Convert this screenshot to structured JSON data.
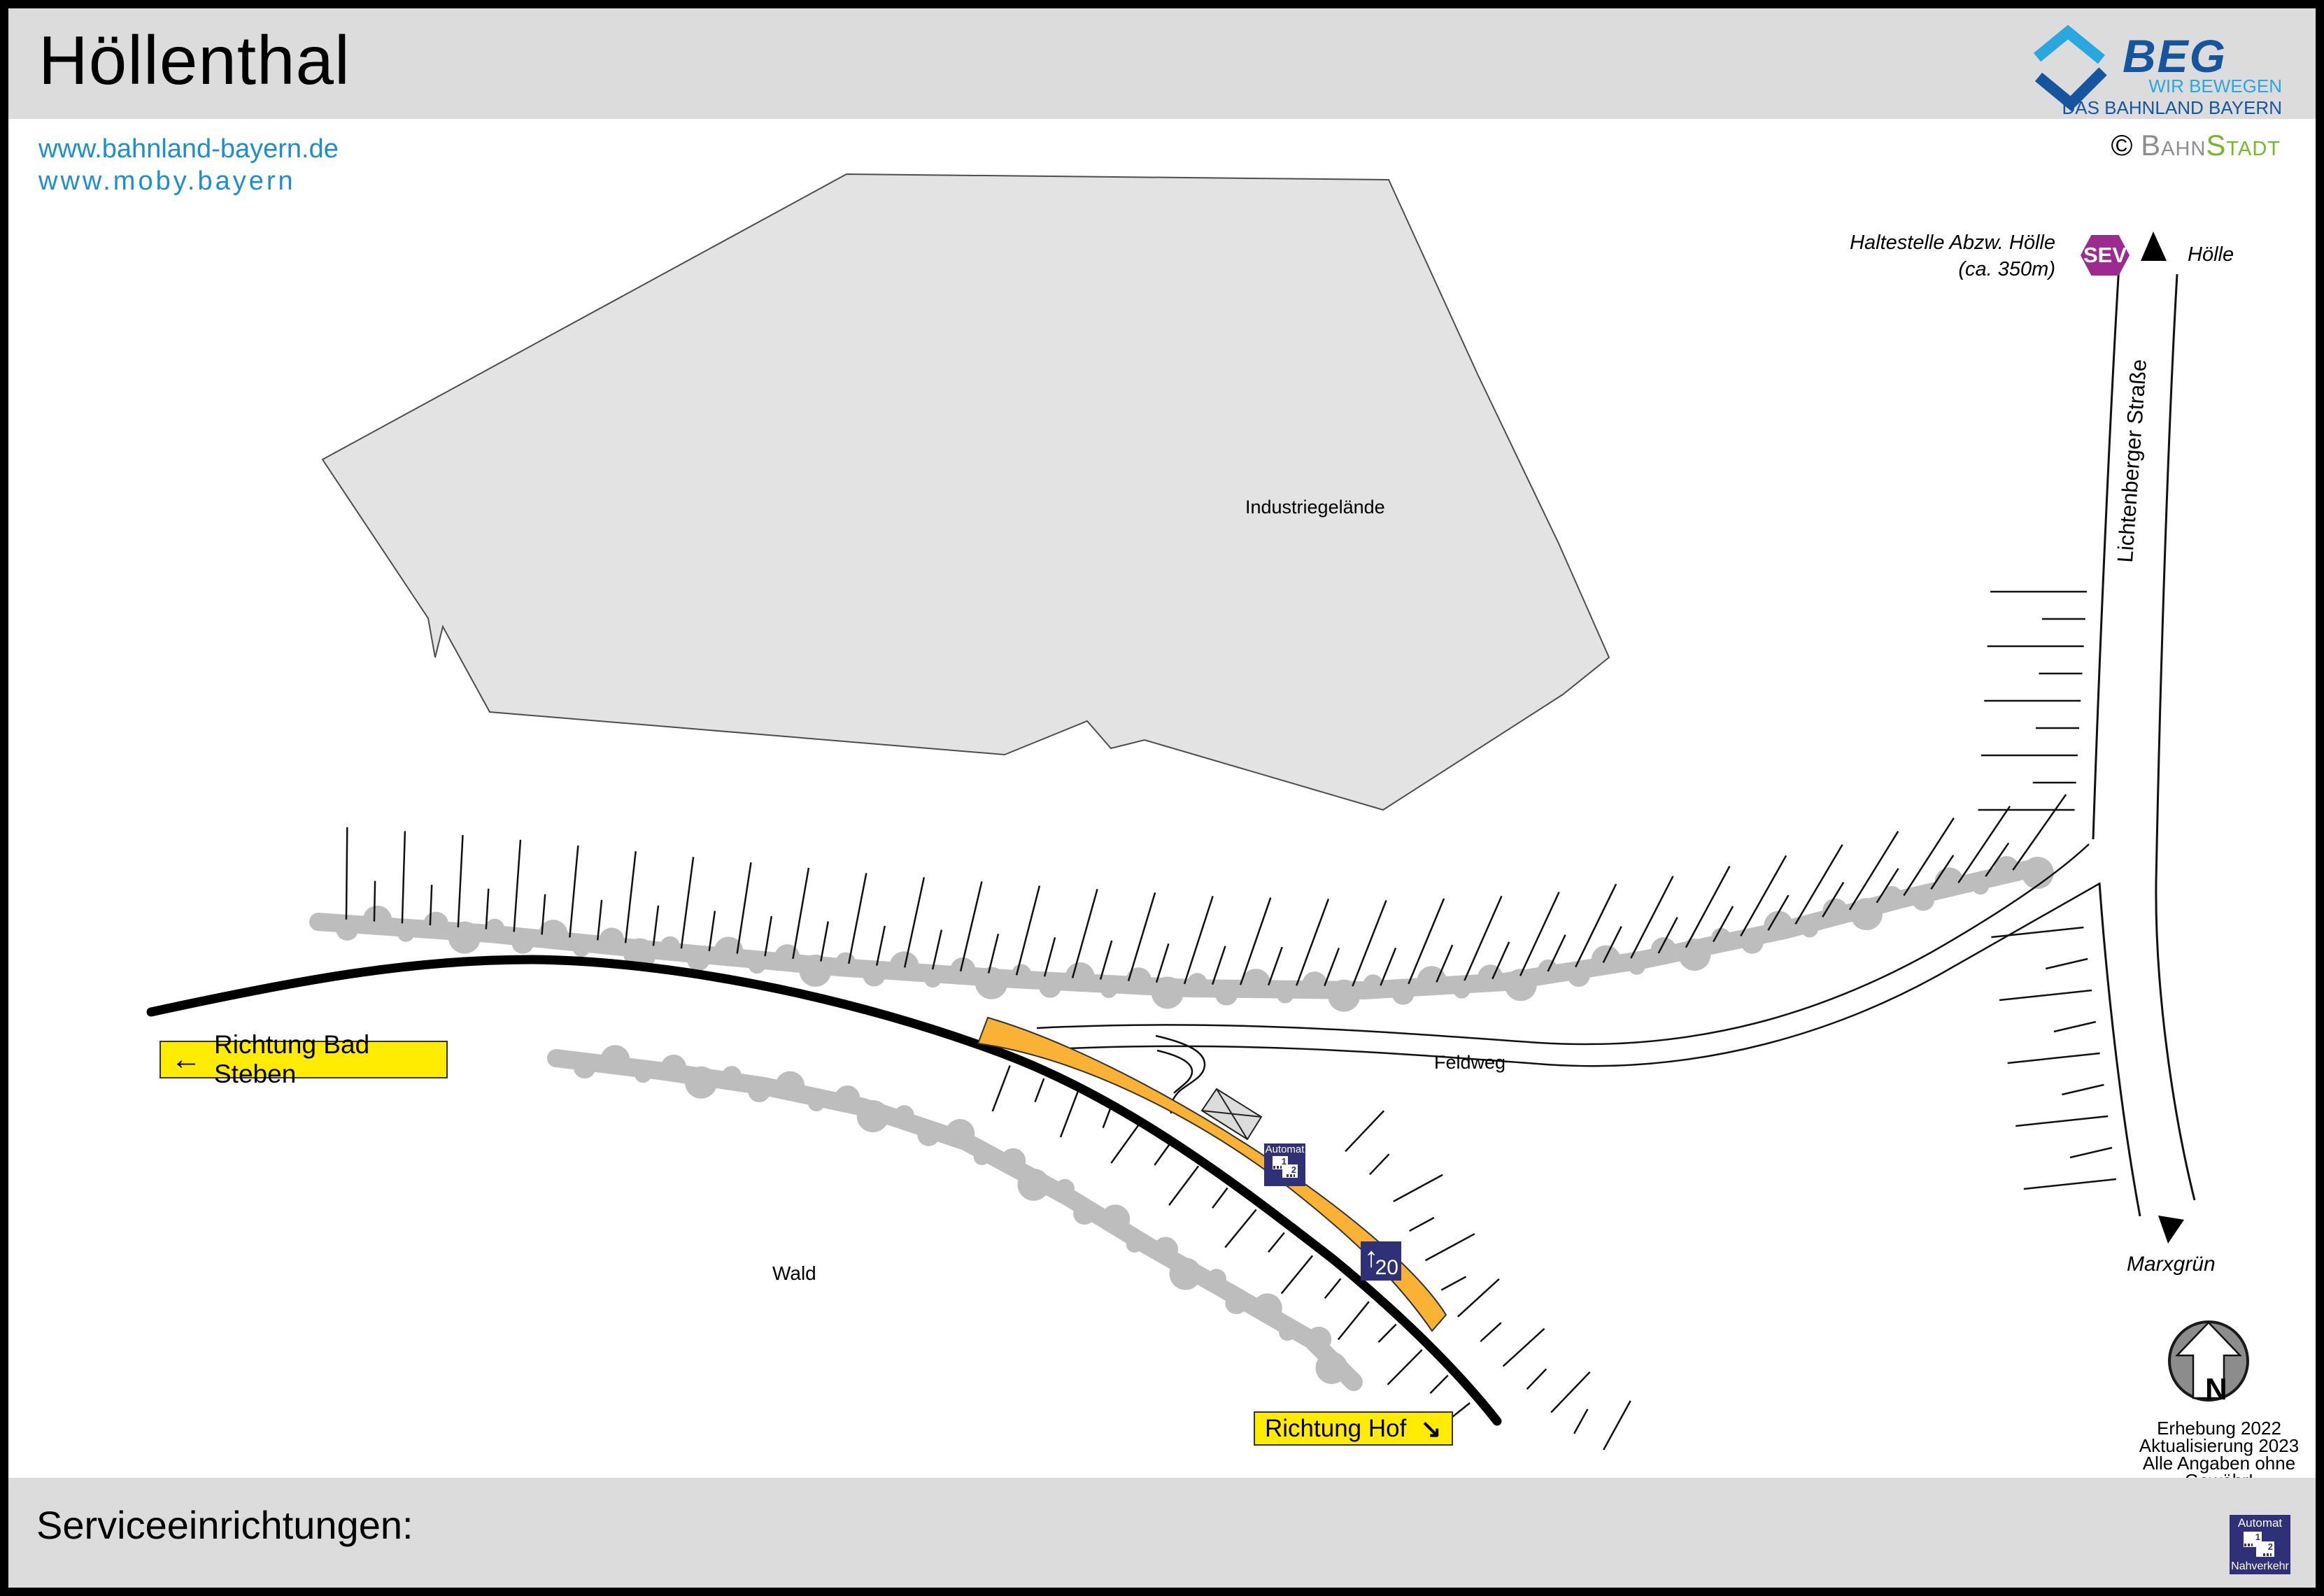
{
  "header": {
    "title": "Höllenthal",
    "link1": "www.bahnland-bayern.de",
    "link2": "www.moby.bayern",
    "brand": {
      "name": "BEG",
      "tagline1": "WIR BEWEGEN",
      "tagline2": "DAS BAHNLAND BAYERN"
    },
    "copyright": {
      "symbol": "©",
      "part1": "Bahn",
      "part2": "Stadt"
    }
  },
  "map": {
    "industrial_area_label": "Industriegelände",
    "sev_badge": "SEV",
    "stop_note_line1": "Haltestelle Abzw. Hölle",
    "stop_note_line2": "(ca. 350m)",
    "direction_top": "Hölle",
    "street_label": "Lichtenberger Straße",
    "direction_bottom": "Marxgrün",
    "path_label": "Feldweg",
    "forest_label": "Wald",
    "direction_left_arrow": "←",
    "direction_left": "Richtung Bad Steben",
    "direction_right": "Richtung Hof",
    "direction_right_arrow": "↘",
    "platform_sign": {
      "arrow": "↑",
      "number": "20"
    },
    "vending_machine_map": {
      "title": "Automat",
      "ticket1": "1",
      "ticket2": "2"
    },
    "compass_letter": "N",
    "survey_line1": "Erhebung 2022",
    "survey_line2": "Aktualisierung 2023",
    "survey_line3": "Alle Angaben ohne Gewähr!"
  },
  "footer": {
    "services_label": "Serviceeinrichtungen:",
    "vending_icon": {
      "title": "Automat",
      "ticket1": "1",
      "ticket2": "2",
      "subtitle": "Nahverkehr"
    }
  },
  "colors": {
    "accent_yellow": "#FFEC00",
    "sev_purple": "#9D2B8F",
    "sign_navy": "#303078",
    "platform_orange": "#F9B234",
    "link_blue": "#1B8ED8",
    "beg_dark_blue": "#15559E",
    "beg_light_blue": "#29A8E0",
    "bahnstadt_green": "#76B82A",
    "tree_gray": "#BDBDBD",
    "area_gray": "#E3E3E3"
  }
}
